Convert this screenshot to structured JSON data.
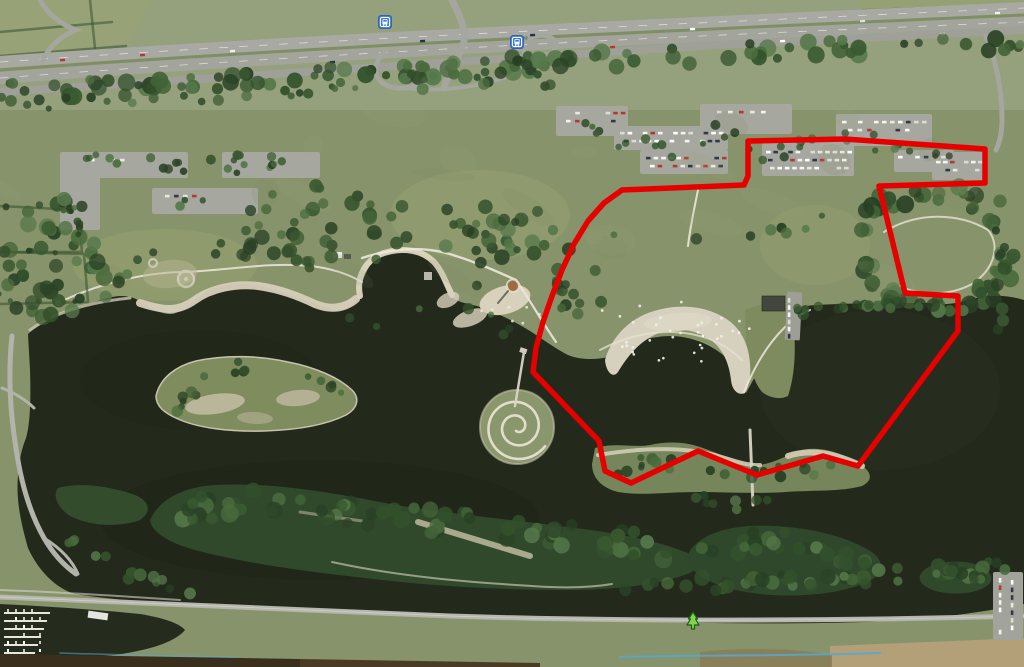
{
  "map": {
    "type": "satellite",
    "colors": {
      "boundary_red": "#e60000",
      "water": "#232a1c",
      "grass": "#87936a",
      "forest": "#3c5833",
      "sand": "#d6d0be",
      "road": "#a8a9a2",
      "transit_marker_blue": "#3a77dd",
      "park_marker_green": "#7ed64e"
    }
  },
  "overlay": {
    "boundary": {
      "label": "highlighted-area",
      "color": "#e60000",
      "stroke_width": 5.5,
      "points": [
        [
          748,
          141
        ],
        [
          845,
          139
        ],
        [
          985,
          149
        ],
        [
          985,
          183
        ],
        [
          879,
          186
        ],
        [
          905,
          293
        ],
        [
          958,
          296
        ],
        [
          958,
          331
        ],
        [
          858,
          466
        ],
        [
          823,
          456
        ],
        [
          757,
          475
        ],
        [
          698,
          451
        ],
        [
          631,
          483
        ],
        [
          605,
          471
        ],
        [
          599,
          441
        ],
        [
          533,
          372
        ],
        [
          536,
          348
        ],
        [
          543,
          322
        ],
        [
          552,
          296
        ],
        [
          562,
          270
        ],
        [
          574,
          244
        ],
        [
          588,
          221
        ],
        [
          604,
          203
        ],
        [
          622,
          190
        ],
        [
          744,
          185
        ],
        [
          748,
          176
        ]
      ]
    }
  },
  "markers": {
    "transit_stops": [
      {
        "id": "bus-stop-1",
        "x": 385,
        "y": 22
      },
      {
        "id": "bus-stop-2",
        "x": 517,
        "y": 42
      }
    ],
    "park_markers": [
      {
        "id": "tree-marker-1",
        "x": 693,
        "y": 621
      }
    ]
  }
}
